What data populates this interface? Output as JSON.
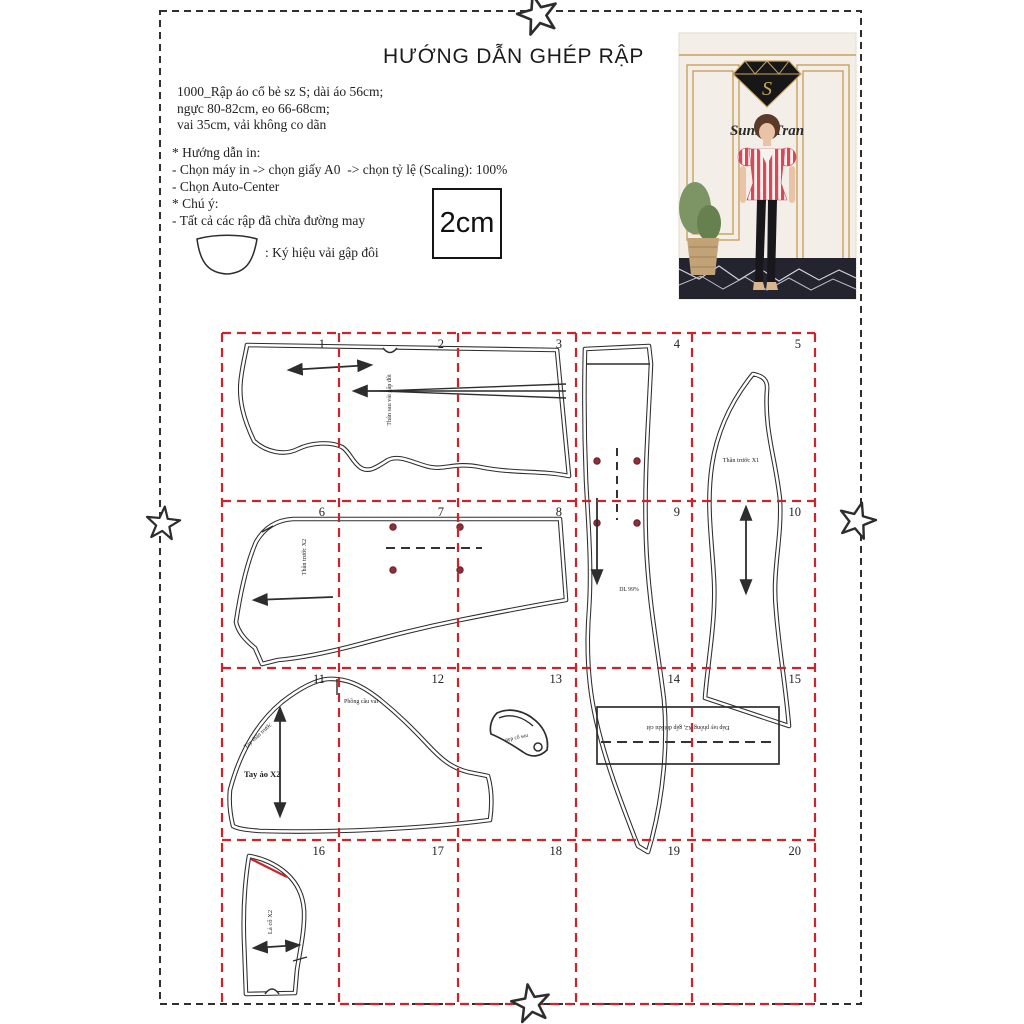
{
  "page": {
    "title": "HƯỚNG DẪN GHÉP RẬP",
    "info_lines": [
      "1000_Rập áo cổ bẻ sz S; dài áo 56cm;",
      "ngực 80-82cm, eo 66-68cm;",
      "vai 35cm, vải không co dãn"
    ],
    "instruction_lines": [
      "* Hướng dẫn in:",
      "- Chọn máy in -> chọn giấy A0  -> chọn tỷ lệ (Scaling): 100%",
      "- Chọn Auto-Center",
      "* Chú ý:",
      "- Tất cả các rập đã chừa đường may"
    ],
    "fold_symbol_label": ": Ký hiệu vải gập đôi",
    "scale_label": "2cm"
  },
  "photo": {
    "brand": "Sunny Tran",
    "logo_letter": "S"
  },
  "grid": {
    "color": "#c9262b",
    "numbers": [
      "1",
      "2",
      "3",
      "4",
      "5",
      "6",
      "7",
      "8",
      "9",
      "10",
      "11",
      "12",
      "13",
      "14",
      "15",
      "16",
      "17",
      "18",
      "19",
      "20"
    ]
  },
  "pieces": {
    "back_label": "Thân sau vải gấp đôi",
    "front2_label": "Thân trước X2",
    "front1_label": "Thân trước X1",
    "side_label": "DL 99%",
    "sleeve_label": "Tay áo X2",
    "sleeve_top_label": "Phồng cầu vai",
    "sleeve_side_label": "Tay thân trước",
    "neck_facing_label": "nẹp cổ sau",
    "band_label": "Đáp tay phồng X2, gấp đôi khi cắt",
    "collar_label": "Lá cổ X2"
  },
  "colors": {
    "grid_red": "#c9262b",
    "outline": "#2d2d2d",
    "dot_maroon": "#8e2f3a",
    "gold": "#c6a25c",
    "top_red": "#d9485a"
  }
}
